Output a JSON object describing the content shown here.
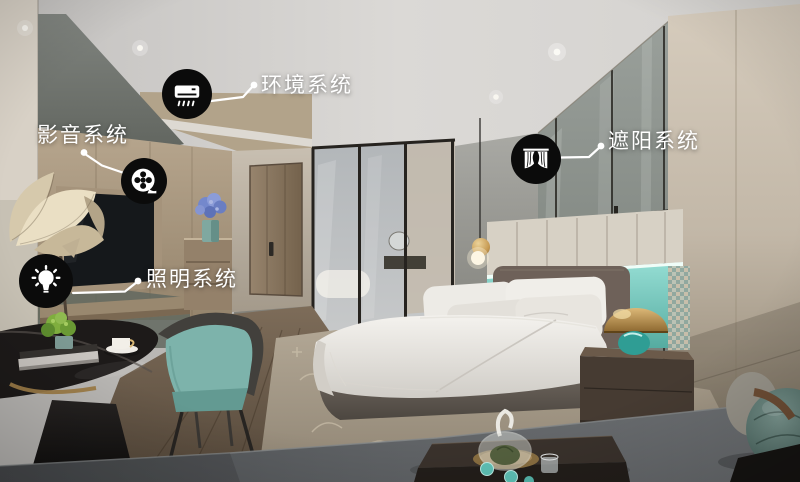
{
  "annotations": [
    {
      "id": "environment",
      "label": "环境系统",
      "icon": "air-conditioner-icon"
    },
    {
      "id": "audio-video",
      "label": "影音系统",
      "icon": "film-reel-icon"
    },
    {
      "id": "lighting",
      "label": "照明系统",
      "icon": "light-bulb-icon"
    },
    {
      "id": "shading",
      "label": "遮阳系统",
      "icon": "curtains-icon"
    }
  ],
  "palette": {
    "badge_background": "#0b0b0b",
    "badge_glyph": "#ffffff",
    "label_text": "#ffffff",
    "leader_line": "#ffffff",
    "teal_accent_wall": "#6fc5ba",
    "gold_lamp": "#c79b54",
    "headboard": "#6b5f57",
    "ceiling": "#d5d3d0"
  }
}
